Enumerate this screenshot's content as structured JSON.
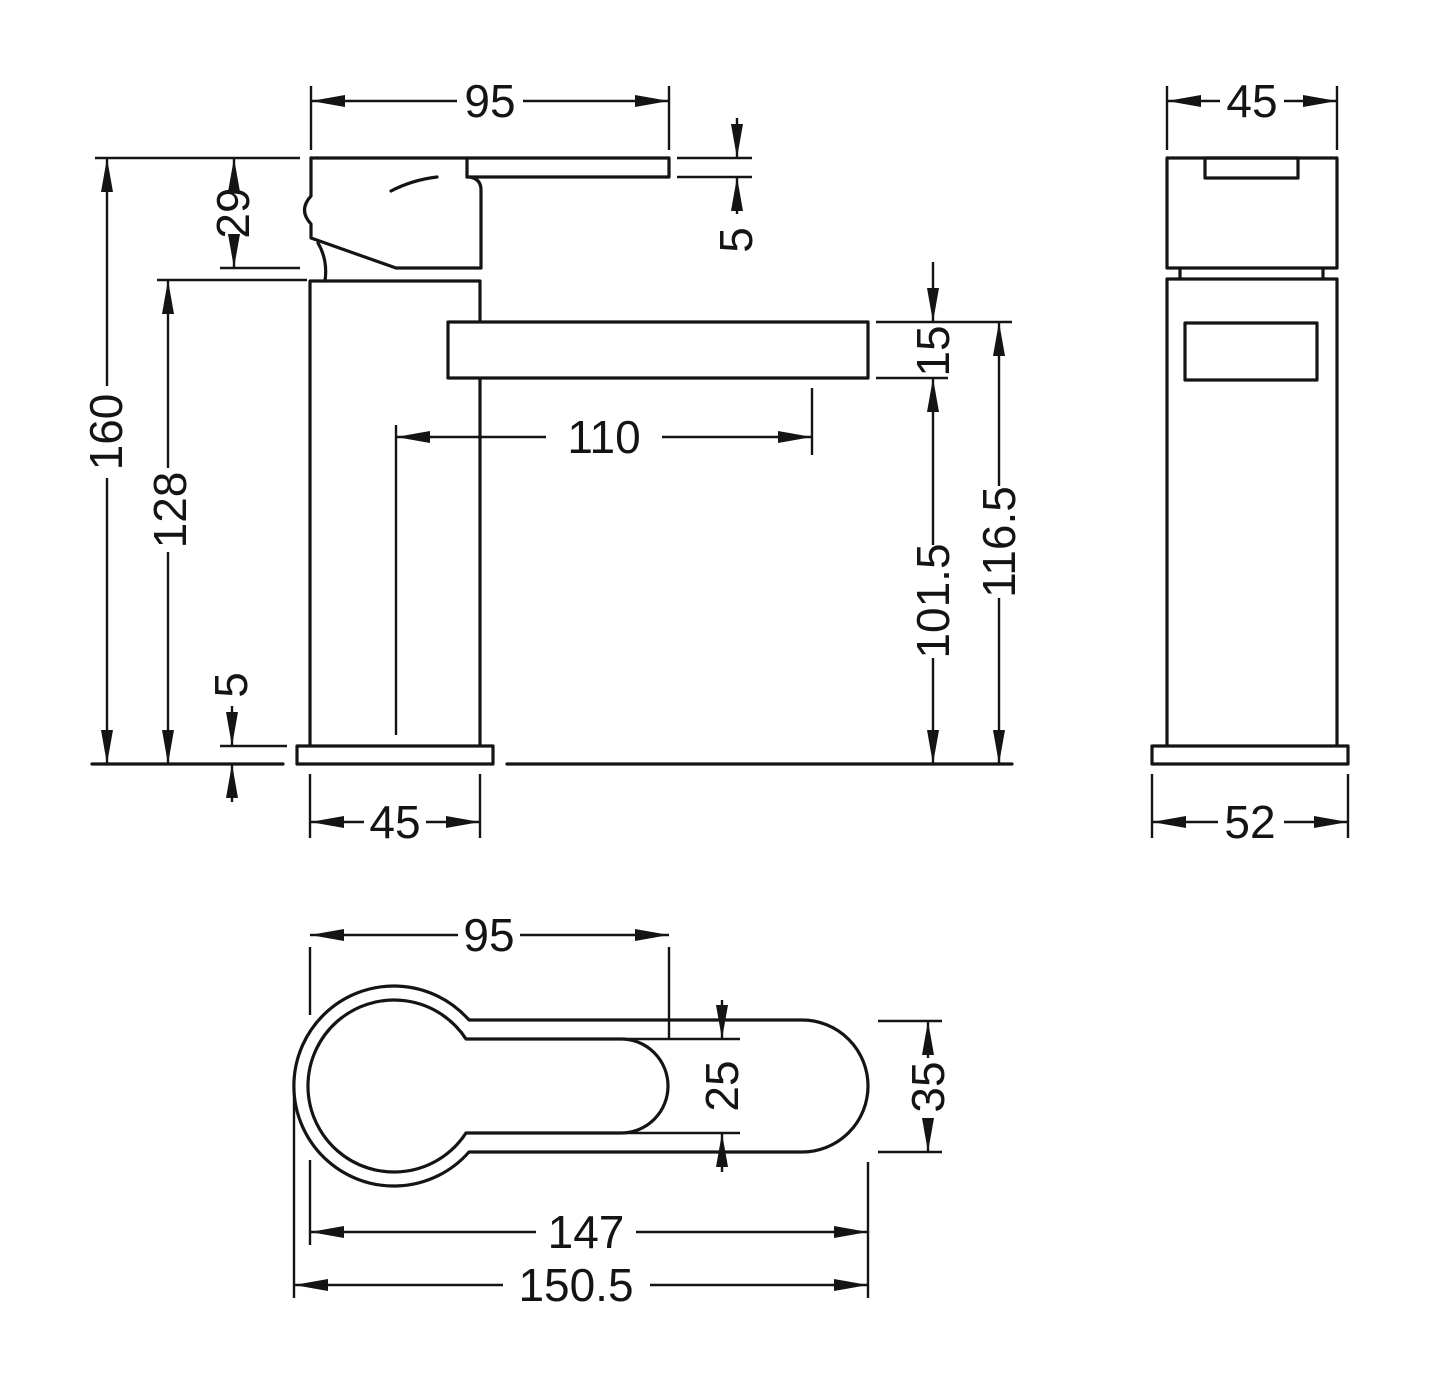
{
  "drawing": {
    "kind": "technical-dimension-drawing",
    "subject": "mono basin mixer tap",
    "units": "mm",
    "line_color": "#141414",
    "background": "#ffffff"
  },
  "views": {
    "front": {
      "name": "front-elevation",
      "dims": {
        "lever_length": "95",
        "lever_tip_thickness": "5",
        "handle_height": "29",
        "overall_height": "160",
        "body_height": "128",
        "base_plate_height": "5",
        "body_width": "45",
        "spout_reach": "110",
        "spout_thickness": "15",
        "height_to_spout_underside": "101.5",
        "height_to_spout_top": "116.5"
      }
    },
    "side": {
      "name": "side-elevation",
      "dims": {
        "head_depth": "45",
        "base_plate_depth": "52"
      }
    },
    "top": {
      "name": "plan-view",
      "dims": {
        "lever_length": "95",
        "lever_width": "25",
        "spout_width": "35",
        "reach_to_lever_tip": "147",
        "overall_reach": "150.5"
      }
    }
  }
}
